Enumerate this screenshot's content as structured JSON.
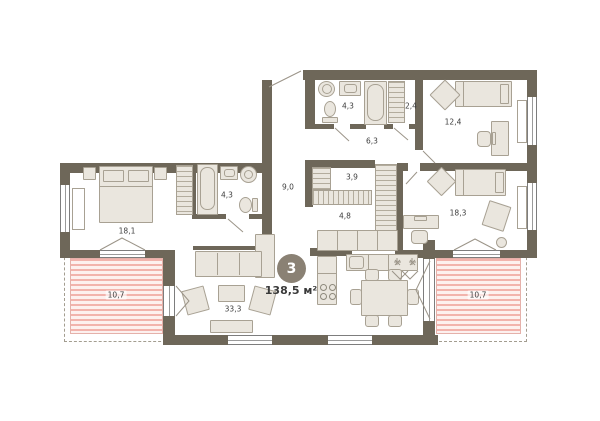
{
  "plan": {
    "badge": {
      "number": "3",
      "total_area": "138,5 м²"
    },
    "rooms": [
      {
        "name": "bedroom-1",
        "area": "18,1"
      },
      {
        "name": "bathroom-1",
        "area": "4,3"
      },
      {
        "name": "entry-hall",
        "area": "9,0"
      },
      {
        "name": "bathroom-2",
        "area": "4,3"
      },
      {
        "name": "storage",
        "area": "2,4"
      },
      {
        "name": "corridor",
        "area": "6,3"
      },
      {
        "name": "bedroom-2",
        "area": "12,4"
      },
      {
        "name": "wardrobe",
        "area": "3,9"
      },
      {
        "name": "hall",
        "area": "4,8"
      },
      {
        "name": "bedroom-3",
        "area": "18,3"
      },
      {
        "name": "living-room",
        "area": "33,3"
      },
      {
        "name": "balcony-left",
        "area": "10,7"
      },
      {
        "name": "balcony-right",
        "area": "10,7"
      }
    ],
    "colors": {
      "wall": "#6e6759",
      "furniture": "#eae6de",
      "balcony_stripe": "#f2b3ac",
      "badge": "#8a8174"
    }
  }
}
